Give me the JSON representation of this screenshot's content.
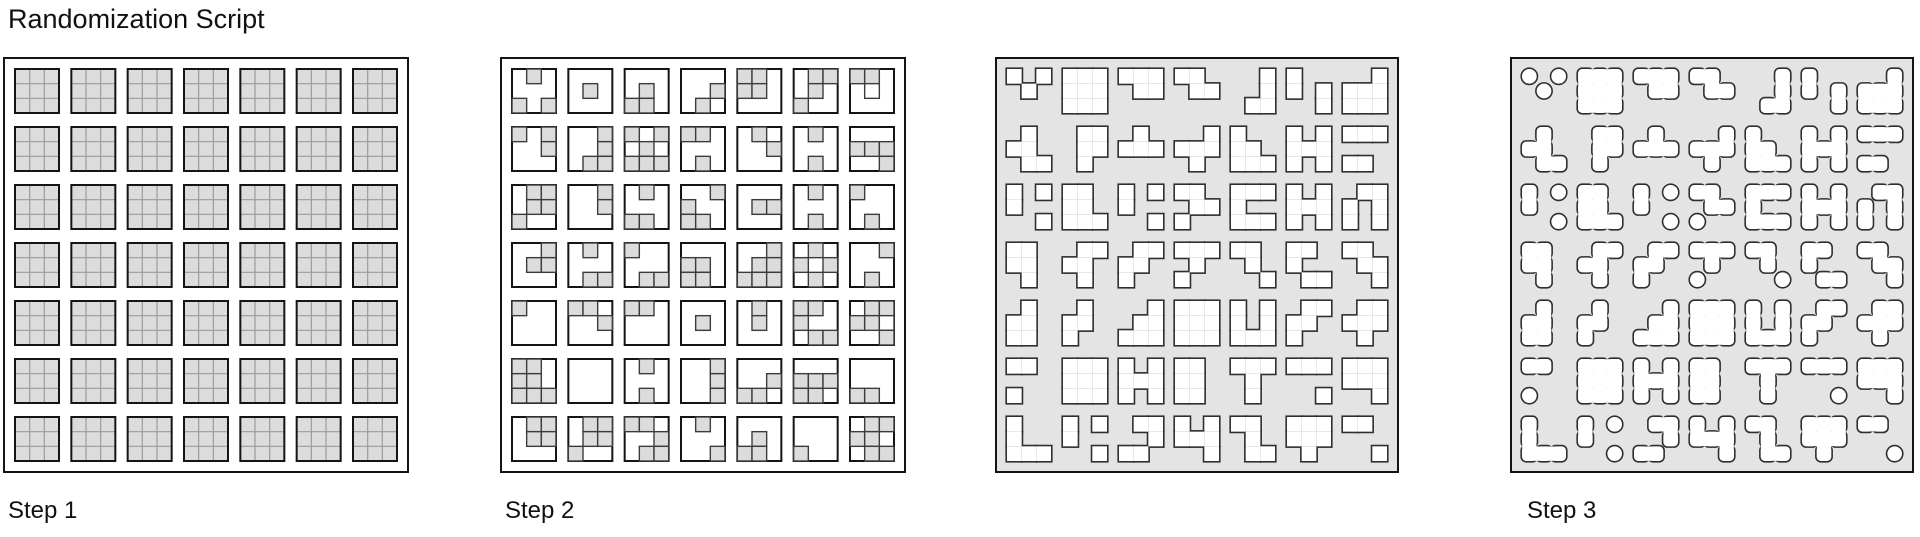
{
  "header": {
    "title": "Randomization Script"
  },
  "colors": {
    "cell_gray": "#dcdcdc",
    "field_gray": "#e4e4e4",
    "cell_outline": "#3c3c3c",
    "square_border": "#141414",
    "panel_border": "#141414",
    "grid_line": "#9b9b9b",
    "shape_outline": "#2f2f2f",
    "white": "#ffffff",
    "text": "#111111"
  },
  "panels": [
    {
      "label": "Step 1",
      "type": "full",
      "x": 3,
      "y": 57,
      "w": 406,
      "h": 416,
      "label_x": 8,
      "rows": [
        [
          "111111111",
          "111111111",
          "111111111",
          "111111111",
          "111111111",
          "111111111",
          "111111111"
        ],
        [
          "111111111",
          "111111111",
          "111111111",
          "111111111",
          "111111111",
          "111111111",
          "111111111"
        ],
        [
          "111111111",
          "111111111",
          "111111111",
          "111111111",
          "111111111",
          "111111111",
          "111111111"
        ],
        [
          "111111111",
          "111111111",
          "111111111",
          "111111111",
          "111111111",
          "111111111",
          "111111111"
        ],
        [
          "111111111",
          "111111111",
          "111111111",
          "111111111",
          "111111111",
          "111111111",
          "111111111"
        ],
        [
          "111111111",
          "111111111",
          "111111111",
          "111111111",
          "111111111",
          "111111111",
          "111111111"
        ],
        [
          "111111111",
          "111111111",
          "111111111",
          "111111111",
          "111111111",
          "111111111",
          "111111111"
        ]
      ]
    },
    {
      "label": "Step 2",
      "type": "cells",
      "x": 500,
      "y": 57,
      "w": 406,
      "h": 416,
      "label_x": 505,
      "rows": [
        [
          "010000101",
          "000010000",
          "000010110",
          "000001010",
          "110110000",
          "011010100",
          "110020000"
        ],
        [
          "101001000",
          "001001011",
          "101010111",
          "110000010",
          "010001000",
          "010000010",
          "000111001"
        ],
        [
          "011011100",
          "001001000",
          "010000110",
          "001100110",
          "000011000",
          "010000010",
          "100000010"
        ],
        [
          "001011000",
          "010000011",
          "100000011",
          "000110110",
          "001011111",
          "010101010",
          "001000010"
        ],
        [
          "100000000",
          "110001000",
          "110000000",
          "000010000",
          "010010000",
          "110100011",
          "011112001"
        ],
        [
          "110110111",
          "000000000",
          "010000010",
          "001001001",
          "000001110",
          "000111110",
          "000000110"
        ],
        [
          "011011000",
          "011011100",
          "110001011",
          "010000001",
          "000010110",
          "000000100",
          "011110011"
        ]
      ]
    },
    {
      "label": "",
      "type": "merged",
      "x": 995,
      "y": 57,
      "w": 404,
      "h": 416,
      "label_x": 1000,
      "rows": [
        [
          "101010000",
          "111111111",
          "111011000",
          "110011000",
          "001001011",
          "100101001",
          "001111111"
        ],
        [
          "010110011",
          "011011010",
          "010111000",
          "001111010",
          "100110111",
          "101111101",
          "111000110"
        ],
        [
          "101100001",
          "110110111",
          "101100001",
          "110011100",
          "111100111",
          "101111101",
          "011101101"
        ],
        [
          "110110010",
          "011110010",
          "011110100",
          "111010100",
          "110010001",
          "110100011",
          "110011001"
        ],
        [
          "010110110",
          "010110100",
          "001011111",
          "111111111",
          "101101111",
          "011110100",
          "011111010"
        ],
        [
          "110000100",
          "111111111",
          "101111101",
          "110110110",
          "111010010",
          "111000001",
          "111111001"
        ],
        [
          "100100111",
          "101100001",
          "011001110",
          "101111001",
          "110010011",
          "111111010",
          "110000001"
        ]
      ]
    },
    {
      "label": "Step 3",
      "type": "merged-round",
      "x": 1510,
      "y": 57,
      "w": 404,
      "h": 416,
      "label_x": 1527,
      "rows": [
        [
          "101010000",
          "111111111",
          "111011000",
          "110011000",
          "001001011",
          "100101001",
          "001111111"
        ],
        [
          "010110011",
          "011011010",
          "010111000",
          "001111010",
          "100110111",
          "101111101",
          "111000110"
        ],
        [
          "101100001",
          "110110111",
          "101100001",
          "110011100",
          "111100111",
          "101111101",
          "011101101"
        ],
        [
          "110110010",
          "011110010",
          "011110100",
          "111010100",
          "110010001",
          "110100011",
          "110011001"
        ],
        [
          "010110110",
          "010110100",
          "001011111",
          "111111111",
          "101101111",
          "011110100",
          "011111010"
        ],
        [
          "110000100",
          "111111111",
          "101111101",
          "110110110",
          "111010010",
          "111000001",
          "111111001"
        ],
        [
          "100100111",
          "101100001",
          "011001110",
          "101111001",
          "110010011",
          "111111010",
          "110000001"
        ]
      ]
    }
  ]
}
